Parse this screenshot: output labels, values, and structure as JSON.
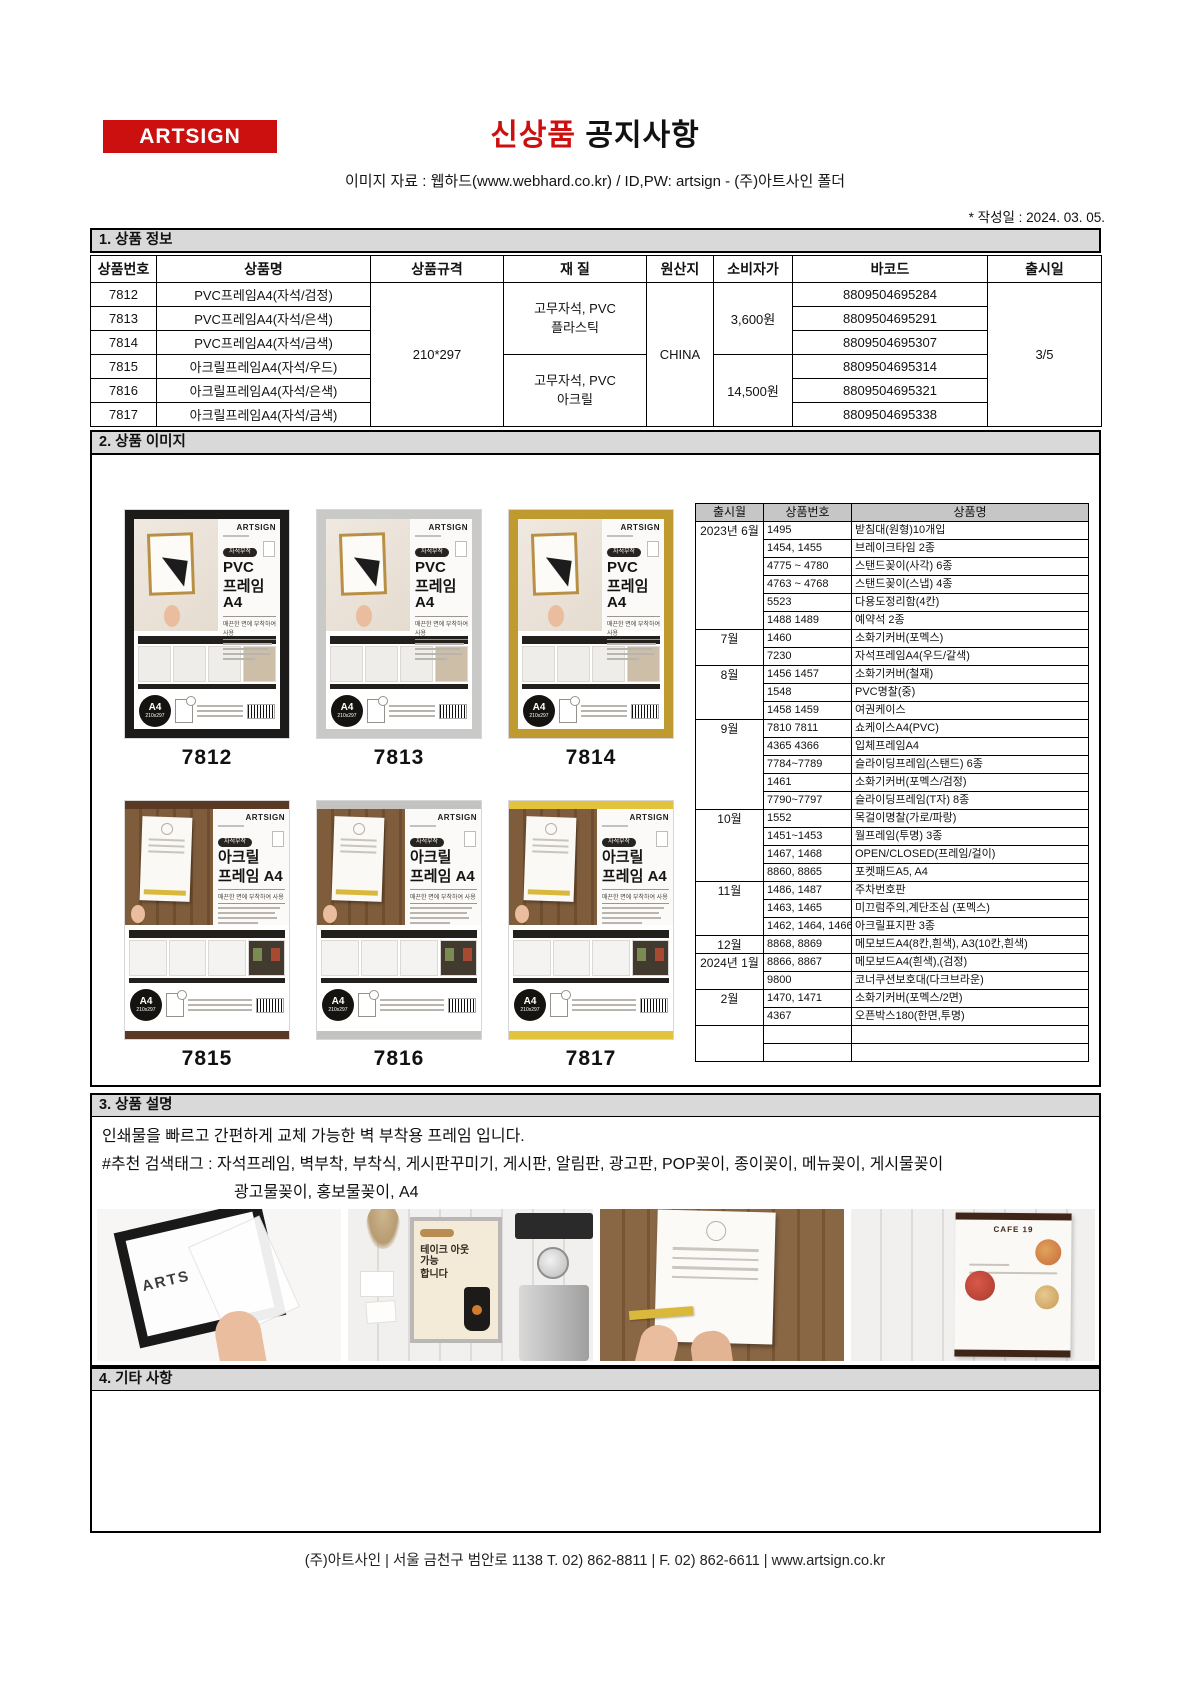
{
  "header": {
    "logo": "ARTSIGN",
    "title_red": "신상품",
    "title_black": " 공지사항",
    "subtitle": "이미지 자료 : 웹하드(www.webhard.co.kr) / ID,PW: artsign - (주)아트사인 폴더",
    "date_note": "* 작성일 : 2024. 03. 05."
  },
  "section1": {
    "title": "1. 상품 정보",
    "columns": [
      "상품번호",
      "상품명",
      "상품규격",
      "재 질",
      "원산지",
      "소비자가",
      "바코드",
      "출시일"
    ],
    "rows": [
      {
        "no": "7812",
        "name": "PVC프레임A4(자석/검정)",
        "barcode": "8809504695284"
      },
      {
        "no": "7813",
        "name": "PVC프레임A4(자석/은색)",
        "barcode": "8809504695291"
      },
      {
        "no": "7814",
        "name": "PVC프레임A4(자석/금색)",
        "barcode": "8809504695307"
      },
      {
        "no": "7815",
        "name": "아크릴프레임A4(자석/우드)",
        "barcode": "8809504695314"
      },
      {
        "no": "7816",
        "name": "아크릴프레임A4(자석/은색)",
        "barcode": "8809504695321"
      },
      {
        "no": "7817",
        "name": "아크릴프레임A4(자석/금색)",
        "barcode": "8809504695338"
      }
    ],
    "spec": "210*297",
    "material1": [
      "고무자석, PVC",
      "플라스틱"
    ],
    "material2": [
      "고무자석, PVC",
      "아크릴"
    ],
    "origin": "CHINA",
    "price1": "3,600원",
    "price2": "14,500원",
    "release": "3/5"
  },
  "section2": {
    "title": "2. 상품 이미지",
    "products": [
      {
        "id": "7812",
        "family": "pvc",
        "frame": "#1d1b1a",
        "brand": "ARTSIGN",
        "badge": "자석부착",
        "title1": "PVC",
        "title2": "프레임 A4",
        "subtitle": "매끈한 면에 부착하여 사용",
        "size_badge": "A4",
        "size_text": "210x297"
      },
      {
        "id": "7813",
        "family": "pvc",
        "frame": "#c9c9c7",
        "brand": "ARTSIGN",
        "badge": "자석부착",
        "title1": "PVC",
        "title2": "프레임 A4",
        "subtitle": "매끈한 면에 부착하여 사용",
        "size_badge": "A4",
        "size_text": "210x297"
      },
      {
        "id": "7814",
        "family": "pvc",
        "frame": "#bf9a2e",
        "brand": "ARTSIGN",
        "badge": "자석부착",
        "title1": "PVC",
        "title2": "프레임 A4",
        "subtitle": "매끈한 면에 부착하여 사용",
        "size_badge": "A4",
        "size_text": "210x297"
      },
      {
        "id": "7815",
        "family": "acrylic",
        "frame": "#5a3a24",
        "brand": "ARTSIGN",
        "badge": "자석부착",
        "title1": "아크릴",
        "title2": "프레임 A4",
        "subtitle": "매끈한 면에 부착하여 사용",
        "size_badge": "A4",
        "size_text": "210x297"
      },
      {
        "id": "7816",
        "family": "acrylic",
        "frame": "#c3c3c1",
        "brand": "ARTSIGN",
        "badge": "자석부착",
        "title1": "아크릴",
        "title2": "프레임 A4",
        "subtitle": "매끈한 면에 부착하여 사용",
        "size_badge": "A4",
        "size_text": "210x297"
      },
      {
        "id": "7817",
        "family": "acrylic",
        "frame": "#e3c33c",
        "brand": "ARTSIGN",
        "badge": "자석부착",
        "title1": "아크릴",
        "title2": "프레임 A4",
        "subtitle": "매끈한 면에 부착하여 사용",
        "size_badge": "A4",
        "size_text": "210x297"
      }
    ],
    "release_table": {
      "columns": [
        "출시월",
        "상품번호",
        "상품명"
      ],
      "groups": [
        {
          "month": "2023년 6월",
          "items": [
            [
              "1495",
              "받침대(원형)10개입"
            ],
            [
              "1454, 1455",
              "브레이크타임 2종"
            ],
            [
              "4775 ~ 4780",
              "스탠드꽂이(사각) 6종"
            ],
            [
              "4763 ~ 4768",
              "스탠드꽂이(스냅) 4종"
            ],
            [
              "5523",
              "다용도정리함(4칸)"
            ],
            [
              "1488 1489",
              "예약석 2종"
            ]
          ]
        },
        {
          "month": "7월",
          "items": [
            [
              "1460",
              "소화기커버(포멕스)"
            ],
            [
              "7230",
              "자석프레임A4(우드/갈색)"
            ]
          ]
        },
        {
          "month": "8월",
          "items": [
            [
              "1456 1457",
              "소화기커버(철재)"
            ],
            [
              "1548",
              "PVC명찰(중)"
            ],
            [
              "1458 1459",
              "여권케이스"
            ]
          ]
        },
        {
          "month": "9월",
          "items": [
            [
              "7810 7811",
              "쇼케이스A4(PVC)"
            ],
            [
              "4365 4366",
              "입체프레임A4"
            ],
            [
              "7784~7789",
              "슬라이딩프레임(스탠드) 6종"
            ],
            [
              "1461",
              "소화기커버(포멕스/검정)"
            ],
            [
              "7790~7797",
              "슬라이딩프레임(T자) 8종"
            ]
          ]
        },
        {
          "month": "10월",
          "items": [
            [
              "1552",
              "목걸이명찰(가로/파랑)"
            ],
            [
              "1451~1453",
              "월프레임(투명) 3종"
            ],
            [
              "1467, 1468",
              "OPEN/CLOSED(프레임/걸이)"
            ],
            [
              "8860, 8865",
              "포켓패드A5, A4"
            ]
          ]
        },
        {
          "month": "11월",
          "items": [
            [
              "1486, 1487",
              "주차번호판"
            ],
            [
              "1463, 1465",
              "미끄럼주의,계단조심 (포멕스)"
            ],
            [
              "1462, 1464, 1466",
              "아크릴표지판 3종"
            ]
          ]
        },
        {
          "month": "12월",
          "items": [
            [
              "8868, 8869",
              "메모보드A4(8칸,흰색), A3(10칸,흰색)"
            ]
          ]
        },
        {
          "month": "2024년 1월",
          "items": [
            [
              "8866, 8867",
              "메모보드A4(흰색),(검정)"
            ],
            [
              "9800",
              "코너쿠션보호대(다크브라운)"
            ]
          ]
        },
        {
          "month": "2월",
          "items": [
            [
              "1470, 1471",
              "소화기커버(포멕스/2면)"
            ],
            [
              "4367",
              "오픈박스180(한면,투명)"
            ]
          ]
        },
        {
          "month": "",
          "items": [
            [
              "",
              ""
            ],
            [
              "",
              ""
            ]
          ]
        }
      ]
    }
  },
  "section3": {
    "title": "3. 상품 설명",
    "line1": "인쇄물을 빠르고 간편하게 교체 가능한 벽 부착용 프레임 입니다.",
    "line2": "#추천 검색태그 :  자석프레임, 벽부착, 부착식, 게시판꾸미기, 게시판, 알림판, 광고판, POP꽂이, 종이꽂이, 메뉴꽂이, 게시물꽂이",
    "line3": "광고물꽂이, 홍보물꽂이, A4",
    "photos": [
      {
        "name": "black-frame-peel",
        "label": "ARTS"
      },
      {
        "name": "cafe-takeout-poster",
        "line1": "테이크 아웃",
        "line2": "가능",
        "line3": "합니다"
      },
      {
        "name": "wood-wall-acrylic-frame"
      },
      {
        "name": "menu-poster",
        "header": "CAFE 19"
      }
    ]
  },
  "section4": {
    "title": "4. 기타 사항"
  },
  "footer": {
    "text": "(주)아트사인  |  서울 금천구 범안로 1138    T. 02) 862-8811   |   F. 02) 862-6611   |   www.artsign.co.kr"
  }
}
